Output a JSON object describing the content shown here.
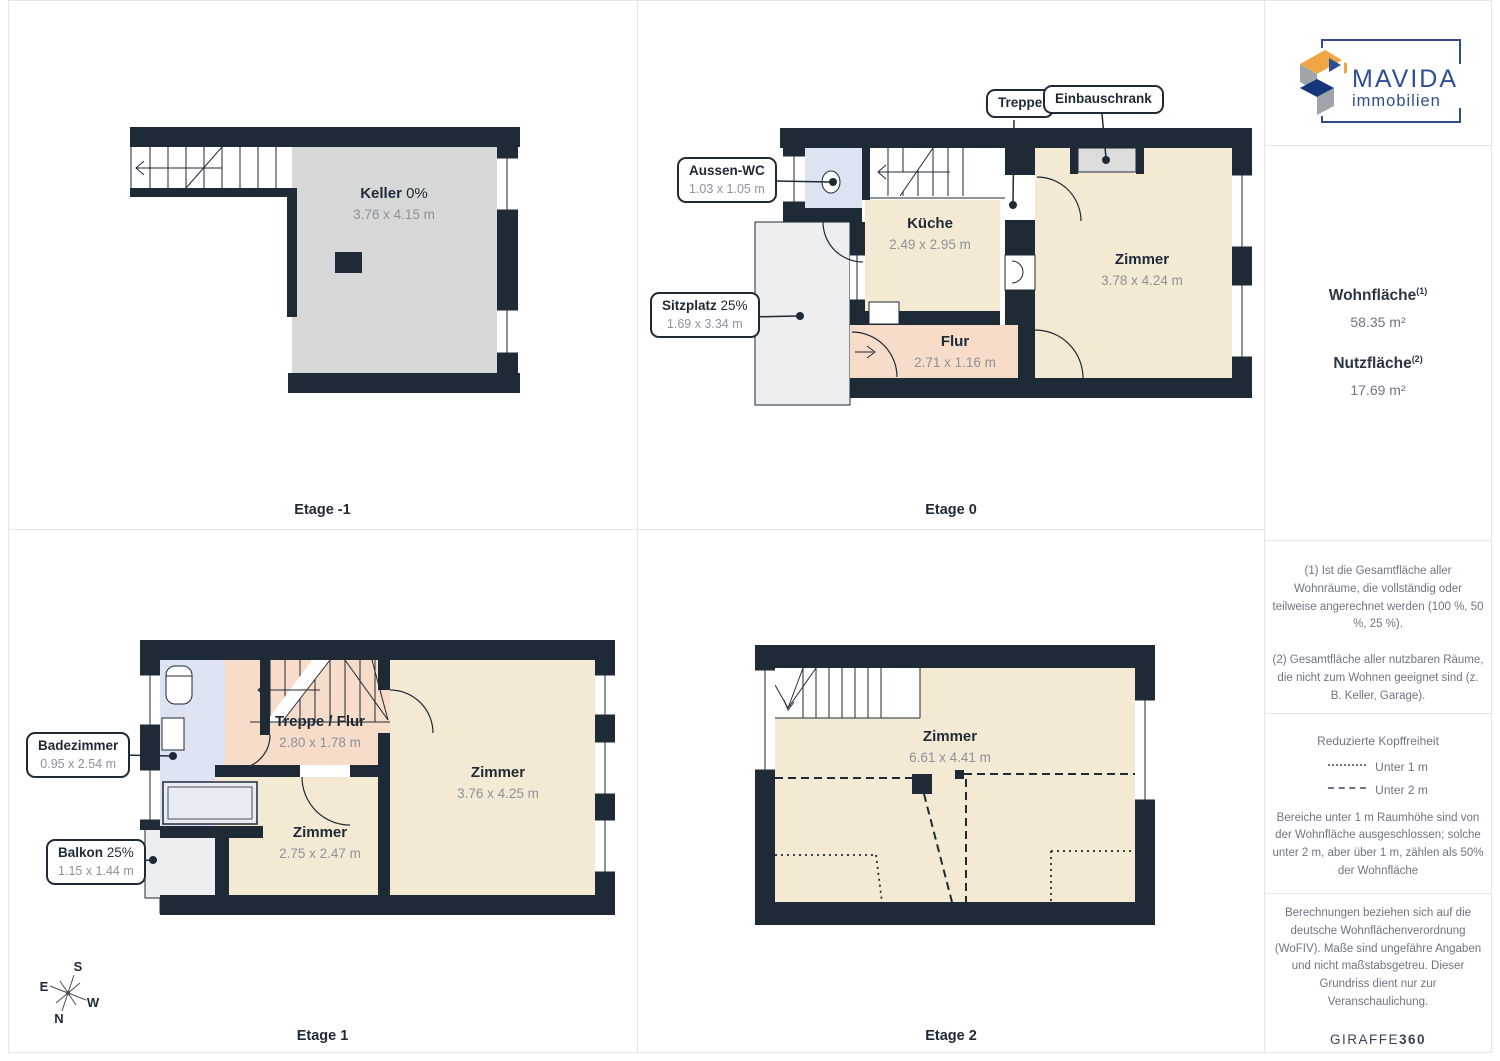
{
  "brand": {
    "name": "MAVIDA",
    "sub": "immobilien"
  },
  "floors": [
    {
      "label": "Etage -1",
      "rooms": [
        {
          "name": "Keller",
          "percent": "0%",
          "dims": "3.76 x 4.15 m"
        }
      ]
    },
    {
      "label": "Etage 0",
      "rooms": [
        {
          "name": "Küche",
          "dims": "2.49 x 2.95 m"
        },
        {
          "name": "Zimmer",
          "dims": "3.78 x 4.24 m"
        },
        {
          "name": "Flur",
          "dims": "2.71 x 1.16 m"
        }
      ],
      "callouts": [
        {
          "name": "Treppe"
        },
        {
          "name": "Einbauschrank"
        },
        {
          "name": "Aussen-WC",
          "dims": "1.03 x 1.05 m"
        },
        {
          "name": "Sitzplatz",
          "percent": "25%",
          "dims": "1.69 x 3.34 m"
        }
      ]
    },
    {
      "label": "Etage 1",
      "rooms": [
        {
          "name": "Treppe / Flur",
          "dims": "2.80 x 1.78 m"
        },
        {
          "name": "Zimmer",
          "dims": "3.76 x 4.25 m"
        },
        {
          "name": "Zimmer",
          "dims": "2.75 x 2.47 m"
        }
      ],
      "callouts": [
        {
          "name": "Badezimmer",
          "dims": "0.95 x 2.54 m"
        },
        {
          "name": "Balkon",
          "percent": "25%",
          "dims": "1.15 x 1.44 m"
        }
      ]
    },
    {
      "label": "Etage 2",
      "rooms": [
        {
          "name": "Zimmer",
          "dims": "6.61 x 4.41 m"
        }
      ]
    }
  ],
  "compass": {
    "n": "N",
    "s": "S",
    "e": "E",
    "w": "W"
  },
  "sidebar": {
    "wohnflaeche": {
      "label": "Wohnfläche",
      "sup": "(1)",
      "value": "58.35 m²"
    },
    "nutzflaeche": {
      "label": "Nutzfläche",
      "sup": "(2)",
      "value": "17.69 m²"
    },
    "footnote1": "(1) Ist die Gesamtfläche aller Wohnräume, die vollständig oder teilweise angerechnet werden (100 %, 50 %, 25 %).",
    "footnote2": "(2) Gesamtfläche aller nutzbaren Räume, die nicht zum Wohnen geeignet sind (z. B. Keller, Garage).",
    "kopffreiheit": {
      "title": "Reduzierte Kopffreiheit",
      "legend1": "Unter 1 m",
      "legend2": "Unter 2 m",
      "note": "Bereiche unter 1 m Raumhöhe sind von der Wohnfläche ausgeschlossen; solche unter 2 m, aber über 1 m, zählen als 50% der Wohnfläche"
    },
    "disclaimer": "Berechnungen beziehen sich auf die deutsche Wohnflächenverordnung (WoFIV). Maße sind ungefähre Angaben und nicht maßstabsgetreu. Dieser Grundriss dient nur zur Veranschaulichung.",
    "footer": {
      "brand": "GIRAFFE",
      "num": "360"
    }
  },
  "colors": {
    "wall": "#1f2a37",
    "room": "#f4e9d2",
    "hallway": "#f6dcc9",
    "bathroom": "#dde3f0",
    "basement": "#d6d7d7",
    "outdoor": "#edeeef",
    "logo_blue": "#2d4f91",
    "logo_orange": "#f0a644",
    "dim_text": "#8d929b"
  }
}
